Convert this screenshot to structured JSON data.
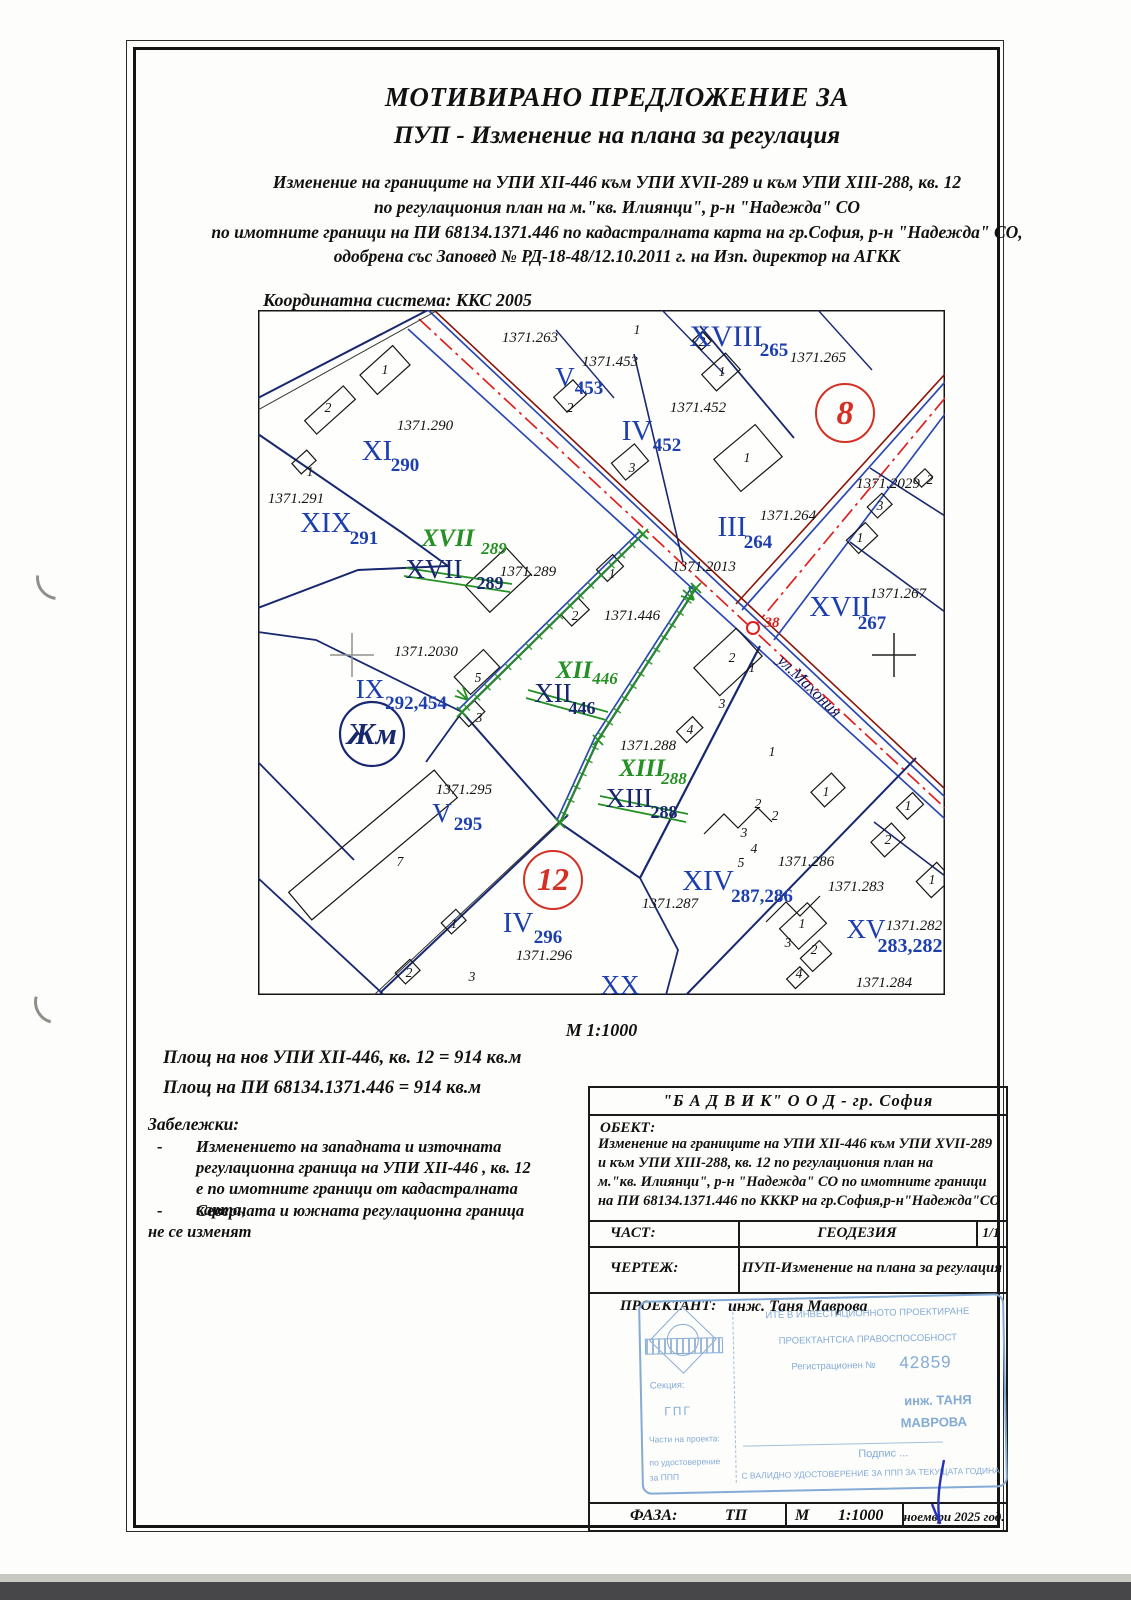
{
  "header": {
    "title1": "МОТИВИРАНО ПРЕДЛОЖЕНИЕ ЗА",
    "title2": "ПУП - Изменение на плана за регулация",
    "intro": [
      "Изменение на границите на УПИ XII-446 към УПИ XVII-289 и към УПИ XIII-288, кв. 12",
      "по регулациония план на м.\"кв. Илиянци\", р-н \"Надежда\" СО",
      "по имотните граници на ПИ 68134.1371.446 по кадастралната карта на гр.София, р-н \"Надежда\" СО,",
      "одобрена със Заповед  № РД-18-48/12.10.2011 г. на Изп. директор на АГКК"
    ]
  },
  "map": {
    "coord_system": "Координатна система: ККС 2005",
    "scale": "М 1:1000",
    "labels": [
      {
        "t": "1371.263",
        "x": 272,
        "y": 32,
        "c": "pid"
      },
      {
        "t": "1",
        "x": 379,
        "y": 24,
        "c": "bld"
      },
      {
        "t": "2",
        "x": 444,
        "y": 36,
        "c": "bld"
      },
      {
        "t": "XVIII",
        "x": 468,
        "y": 36,
        "c": "upi",
        "s": 30
      },
      {
        "t": "265",
        "x": 516,
        "y": 46,
        "c": "sub"
      },
      {
        "t": "1371.265",
        "x": 560,
        "y": 52,
        "c": "pid"
      },
      {
        "t": "1371.453",
        "x": 352,
        "y": 56,
        "c": "pid"
      },
      {
        "t": "V",
        "x": 307,
        "y": 76,
        "c": "upi",
        "s": 27
      },
      {
        "t": "453",
        "x": 331,
        "y": 84,
        "c": "sub"
      },
      {
        "t": "1",
        "x": 464,
        "y": 66,
        "c": "bld"
      },
      {
        "t": "2",
        "x": 312,
        "y": 102,
        "c": "bld"
      },
      {
        "t": "8",
        "x": 587,
        "y": 114,
        "c": "red"
      },
      {
        "t": "1371.290",
        "x": 167,
        "y": 120,
        "c": "pid"
      },
      {
        "t": "1",
        "x": 127,
        "y": 64,
        "c": "bld"
      },
      {
        "t": "2",
        "x": 70,
        "y": 102,
        "c": "bld"
      },
      {
        "t": "1371.452",
        "x": 440,
        "y": 102,
        "c": "pid"
      },
      {
        "t": "IV",
        "x": 379,
        "y": 130,
        "c": "upi",
        "s": 29
      },
      {
        "t": "452",
        "x": 409,
        "y": 141,
        "c": "sub"
      },
      {
        "t": "XI",
        "x": 119,
        "y": 150,
        "c": "upi",
        "s": 29
      },
      {
        "t": "290",
        "x": 147,
        "y": 161,
        "c": "sub"
      },
      {
        "t": "1",
        "x": 489,
        "y": 152,
        "c": "bld"
      },
      {
        "t": "3",
        "x": 374,
        "y": 162,
        "c": "bld"
      },
      {
        "t": "1",
        "x": 52,
        "y": 166,
        "c": "bld"
      },
      {
        "t": "1371.291",
        "x": 38,
        "y": 193,
        "c": "pid"
      },
      {
        "t": "XIX",
        "x": 68,
        "y": 222,
        "c": "upi",
        "s": 29
      },
      {
        "t": "291",
        "x": 106,
        "y": 234,
        "c": "sub"
      },
      {
        "t": "III",
        "x": 474,
        "y": 226,
        "c": "upi",
        "s": 29
      },
      {
        "t": "264",
        "x": 500,
        "y": 238,
        "c": "sub"
      },
      {
        "t": "1371.264",
        "x": 530,
        "y": 210,
        "c": "pid"
      },
      {
        "t": "1371.2029",
        "x": 630,
        "y": 178,
        "c": "pid"
      },
      {
        "t": "2",
        "x": 672,
        "y": 174,
        "c": "bld"
      },
      {
        "t": "3",
        "x": 622,
        "y": 200,
        "c": "bld"
      },
      {
        "t": "1",
        "x": 602,
        "y": 232,
        "c": "bld"
      },
      {
        "t": "XVII",
        "x": 190,
        "y": 236,
        "c": "gr"
      },
      {
        "t": "289",
        "x": 236,
        "y": 244,
        "c": "grs"
      },
      {
        "t": "XVII",
        "x": 176,
        "y": 268,
        "c": "old"
      },
      {
        "t": "289",
        "x": 232,
        "y": 279,
        "c": "olds"
      },
      {
        "t": "1371.289",
        "x": 270,
        "y": 266,
        "c": "pid"
      },
      {
        "t": "1371.2013",
        "x": 446,
        "y": 261,
        "c": "pid"
      },
      {
        "t": "1",
        "x": 354,
        "y": 268,
        "c": "bld"
      },
      {
        "t": "2",
        "x": 317,
        "y": 310,
        "c": "bld"
      },
      {
        "t": "1371.446",
        "x": 374,
        "y": 310,
        "c": "pid"
      },
      {
        "t": "1371.267",
        "x": 640,
        "y": 288,
        "c": "pid"
      },
      {
        "t": "XVII",
        "x": 582,
        "y": 306,
        "c": "upi",
        "s": 29
      },
      {
        "t": "267",
        "x": 614,
        "y": 319,
        "c": "sub"
      },
      {
        "t": "38",
        "x": 514,
        "y": 317,
        "c": "red2"
      },
      {
        "t": "ул.Махония",
        "x": 548,
        "y": 380,
        "c": "str",
        "r": 44
      },
      {
        "t": "1371.2030",
        "x": 168,
        "y": 346,
        "c": "pid"
      },
      {
        "t": "IX",
        "x": 112,
        "y": 388,
        "c": "upi",
        "s": 27
      },
      {
        "t": "292,454",
        "x": 158,
        "y": 399,
        "c": "sub"
      },
      {
        "t": "5",
        "x": 220,
        "y": 372,
        "c": "bld"
      },
      {
        "t": "3",
        "x": 221,
        "y": 412,
        "c": "bld"
      },
      {
        "t": "Жм",
        "x": 114,
        "y": 434,
        "c": "zh"
      },
      {
        "t": "XII",
        "x": 316,
        "y": 368,
        "c": "gr"
      },
      {
        "t": "446",
        "x": 347,
        "y": 374,
        "c": "grs"
      },
      {
        "t": "XII",
        "x": 295,
        "y": 392,
        "c": "old"
      },
      {
        "t": "446",
        "x": 324,
        "y": 404,
        "c": "olds"
      },
      {
        "t": "2",
        "x": 474,
        "y": 352,
        "c": "bld"
      },
      {
        "t": "1",
        "x": 494,
        "y": 362,
        "c": "bld"
      },
      {
        "t": "3",
        "x": 464,
        "y": 398,
        "c": "bld"
      },
      {
        "t": "4",
        "x": 432,
        "y": 424,
        "c": "bld"
      },
      {
        "t": "1371.288",
        "x": 390,
        "y": 440,
        "c": "pid"
      },
      {
        "t": "XIII",
        "x": 384,
        "y": 466,
        "c": "gr"
      },
      {
        "t": "288",
        "x": 416,
        "y": 474,
        "c": "grs"
      },
      {
        "t": "XIII",
        "x": 371,
        "y": 497,
        "c": "old"
      },
      {
        "t": "288",
        "x": 406,
        "y": 508,
        "c": "olds"
      },
      {
        "t": "1",
        "x": 514,
        "y": 446,
        "c": "bld"
      },
      {
        "t": "1371.295",
        "x": 206,
        "y": 484,
        "c": "pid"
      },
      {
        "t": "V",
        "x": 184,
        "y": 512,
        "c": "upi",
        "s": 27
      },
      {
        "t": "295",
        "x": 210,
        "y": 520,
        "c": "sub"
      },
      {
        "t": "7",
        "x": 142,
        "y": 556,
        "c": "bld"
      },
      {
        "t": "12",
        "x": 295,
        "y": 580,
        "c": "red",
        "s": 32
      },
      {
        "t": "1371.287",
        "x": 412,
        "y": 598,
        "c": "pid"
      },
      {
        "t": "XIV",
        "x": 450,
        "y": 580,
        "c": "upi",
        "s": 29
      },
      {
        "t": "287,286",
        "x": 504,
        "y": 592,
        "c": "sub"
      },
      {
        "t": "1371.286",
        "x": 548,
        "y": 556,
        "c": "pid"
      },
      {
        "t": "1371.283",
        "x": 598,
        "y": 581,
        "c": "pid"
      },
      {
        "t": "2",
        "x": 500,
        "y": 498,
        "c": "bld"
      },
      {
        "t": "2",
        "x": 517,
        "y": 510,
        "c": "bld"
      },
      {
        "t": "3",
        "x": 486,
        "y": 527,
        "c": "bld"
      },
      {
        "t": "4",
        "x": 496,
        "y": 543,
        "c": "bld"
      },
      {
        "t": "5",
        "x": 483,
        "y": 557,
        "c": "bld"
      },
      {
        "t": "1",
        "x": 568,
        "y": 486,
        "c": "bld"
      },
      {
        "t": "1",
        "x": 650,
        "y": 500,
        "c": "bld"
      },
      {
        "t": "2",
        "x": 630,
        "y": 534,
        "c": "bld"
      },
      {
        "t": "1",
        "x": 674,
        "y": 574,
        "c": "bld"
      },
      {
        "t": "XV",
        "x": 608,
        "y": 628,
        "c": "upi",
        "s": 27
      },
      {
        "t": "1371.282",
        "x": 656,
        "y": 620,
        "c": "pid"
      },
      {
        "t": "283,282",
        "x": 652,
        "y": 642,
        "c": "sub",
        "s": 20
      },
      {
        "t": "IV",
        "x": 260,
        "y": 622,
        "c": "upi",
        "s": 29
      },
      {
        "t": "296",
        "x": 290,
        "y": 633,
        "c": "sub"
      },
      {
        "t": "1371.296",
        "x": 286,
        "y": 650,
        "c": "pid"
      },
      {
        "t": "1",
        "x": 196,
        "y": 618,
        "c": "bld"
      },
      {
        "t": "2",
        "x": 151,
        "y": 667,
        "c": "bld"
      },
      {
        "t": "3",
        "x": 214,
        "y": 671,
        "c": "bld"
      },
      {
        "t": "1",
        "x": 544,
        "y": 618,
        "c": "bld"
      },
      {
        "t": "3",
        "x": 530,
        "y": 637,
        "c": "bld"
      },
      {
        "t": "2",
        "x": 556,
        "y": 644,
        "c": "bld"
      },
      {
        "t": "4",
        "x": 541,
        "y": 668,
        "c": "bld"
      },
      {
        "t": "XX",
        "x": 362,
        "y": 684,
        "c": "upi",
        "s": 27
      },
      {
        "t": "1371.284",
        "x": 626,
        "y": 677,
        "c": "pid"
      }
    ]
  },
  "areas": {
    "line1": "Площ на нов УПИ XII-446, кв. 12 = 914 кв.м",
    "line2": "Площ на ПИ 68134.1371.446 = 914 кв.м"
  },
  "notes": {
    "heading": "Забележки:",
    "dash": "-",
    "items": [
      "Изменението на западната и източната регулационна граница на УПИ XII-446 , кв. 12 е по имотните граници от кадастралната карта;",
      "Северната и южната регулационна граница"
    ],
    "footer": "не се изменят"
  },
  "titleblock": {
    "company": "\"Б А Д В И К\" О О Д - гр. София",
    "object_label": "ОБЕКТ:",
    "object_lines": [
      "Изменение на границите на УПИ XII-446 към УПИ XVII-289",
      "и към УПИ XIII-288, кв. 12 по регулациония план на",
      "м.\"кв. Илиянци\", р-н \"Надежда\" СО по имотните граници",
      "на ПИ 68134.1371.446 по КККР на гр.София,р-н\"Надежда\"СО"
    ],
    "part_label": "ЧАСТ:",
    "part_value": "ГЕОДЕЗИЯ",
    "sheet": "1/1",
    "drawing_label": "ЧЕРТЕЖ:",
    "drawing_value": "ПУП-Изменение на плана за регулация",
    "designer_label": "ПРОЕКТАНТ:",
    "designer_value": "инж. Таня Маврова",
    "phase_label": "ФАЗА:",
    "phase_value": "ТП",
    "scale_label": "М",
    "scale_value": "1:1000",
    "date": "ноември 2025 год."
  },
  "stamp": {
    "line1": "ИТЕ В ИНВЕСТИЦИОННОТО ПРОЕКТИРАНЕ",
    "line2": "ПРОЕКТАНТСКА ПРАВОСПОСОБНОСТ",
    "reg_label": "Регистрационен №",
    "reg_number": "42859",
    "section_label": "Секция:",
    "section_value": "ГПГ",
    "parts_label": "Части на проекта:",
    "parts_line1": "по удостоверение",
    "parts_line2": "за ППП",
    "name_line1": "инж. ТАНЯ",
    "name_line2": "МАВРОВА",
    "sign_label": "Подпис ...",
    "bottom_line": "С ВАЛИДНО УДОСТОВЕРЕНИЕ ЗА ППП ЗА ТЕКУЩАТА ГОДИНА"
  },
  "colors": {
    "regulation_navy": "#17286f",
    "new_boundary_green": "#259025",
    "street_axis_red": "#e02020",
    "zone_circle_red": "#d43024",
    "stamp_blue": "#84abd6"
  }
}
